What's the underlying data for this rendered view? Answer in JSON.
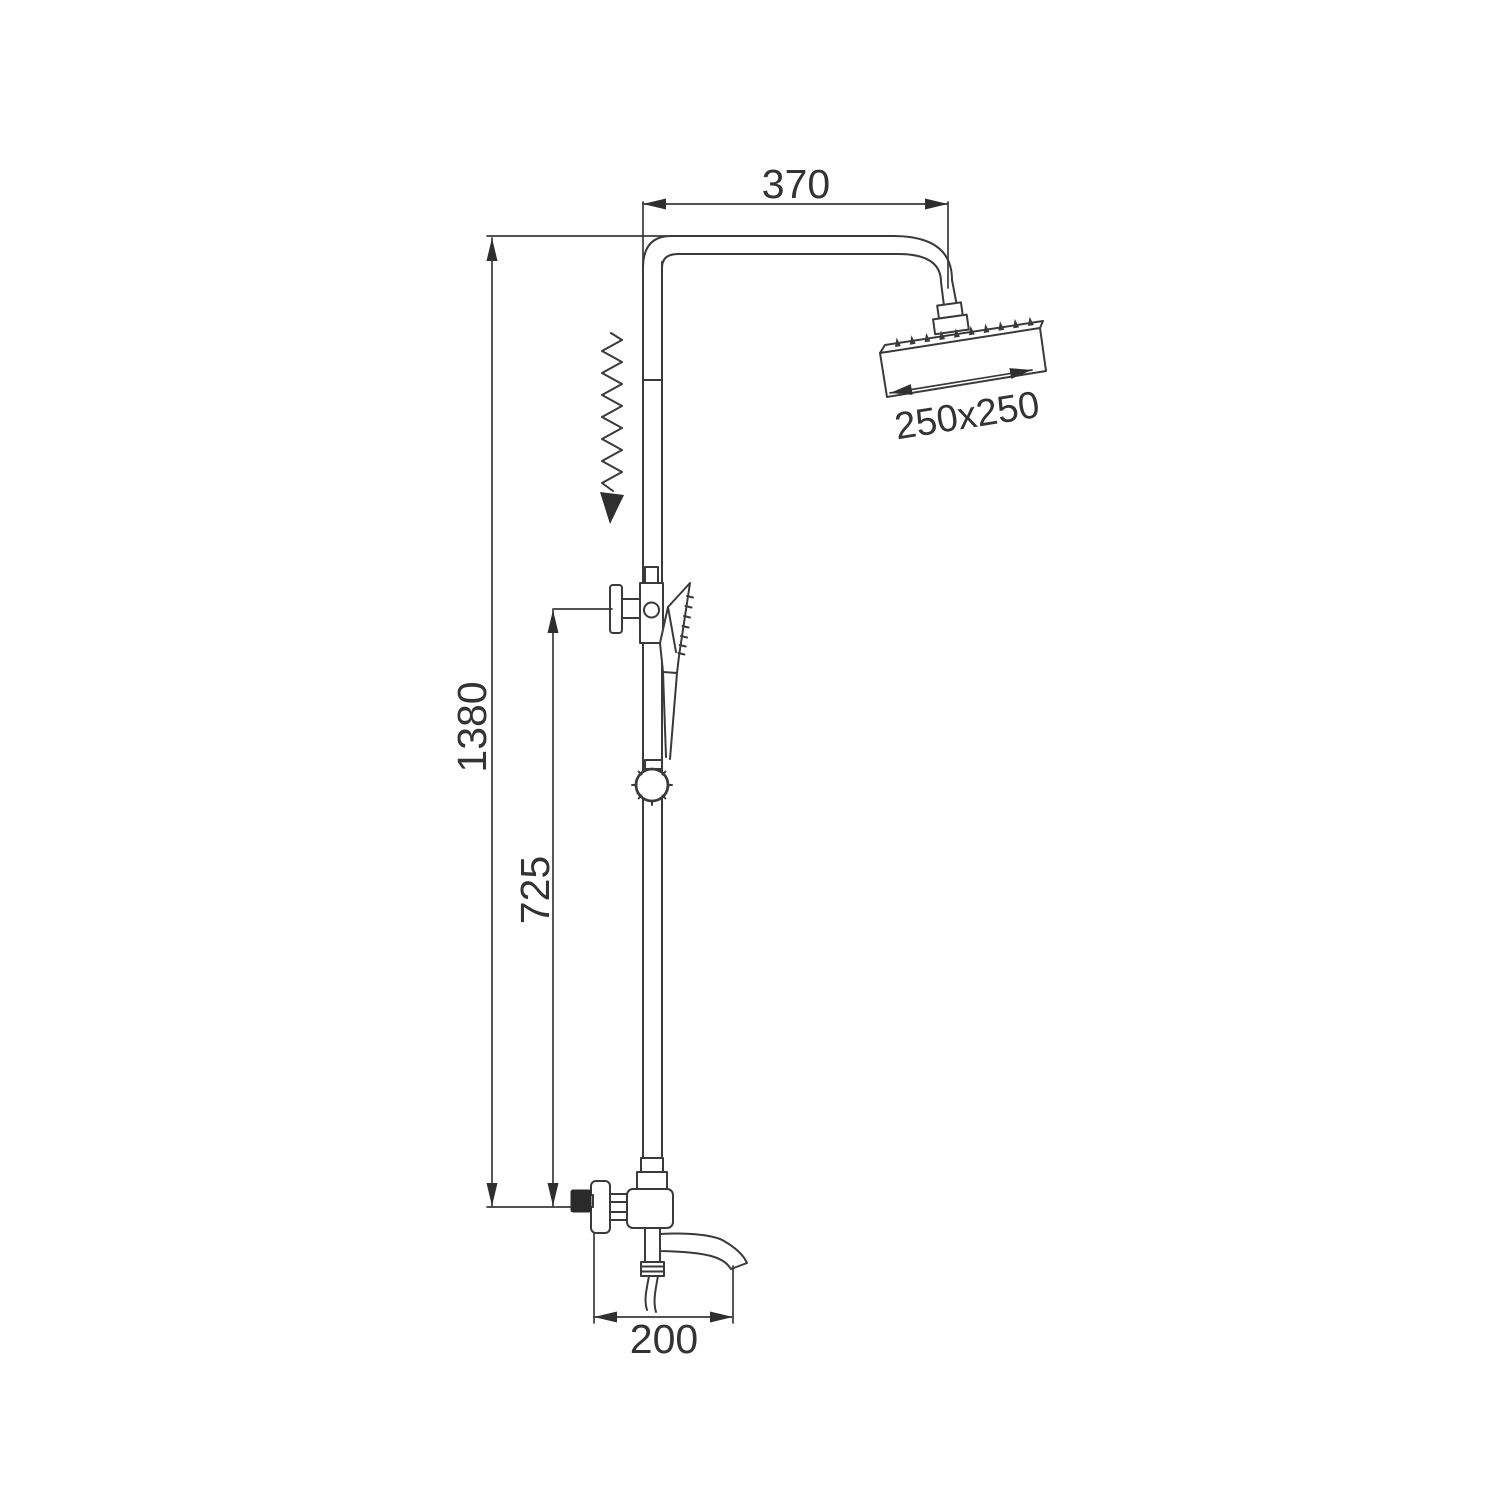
{
  "drawing": {
    "background": "#ffffff",
    "line_color": "#3a3a3a",
    "text_color": "#333333",
    "handle_fill": "#2a2a2a"
  },
  "dimensions": {
    "top_width": "370",
    "head_size": "250x250",
    "overall_height": "1380",
    "mid_height": "725",
    "bottom_width": "200"
  }
}
